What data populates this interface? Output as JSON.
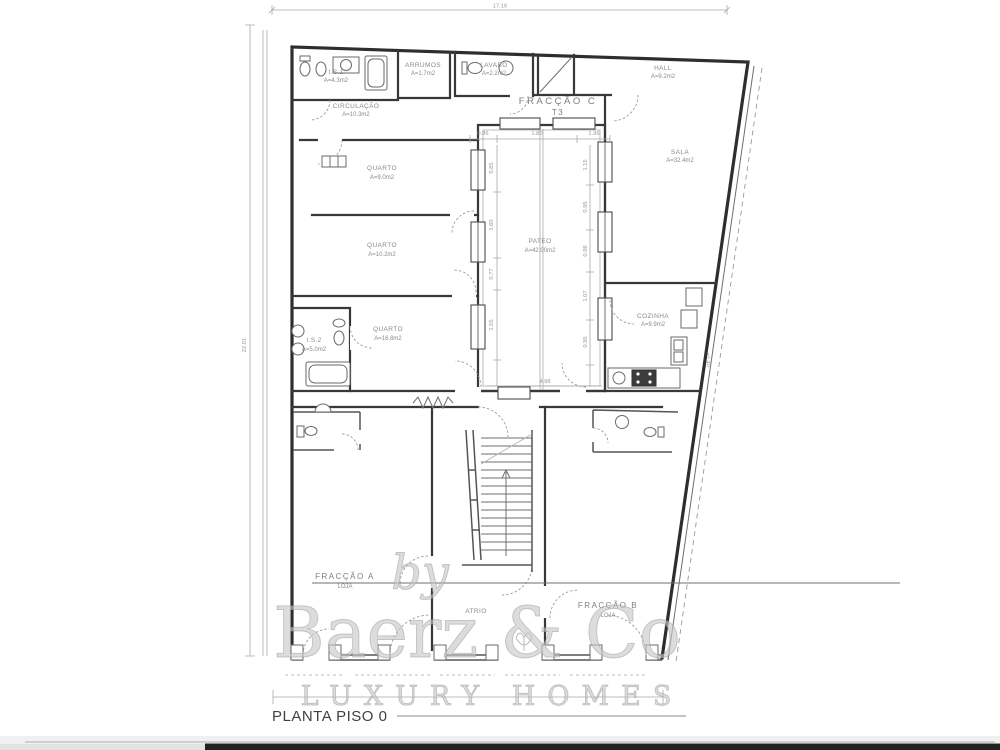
{
  "plan_title": "PLANTA PISO 0",
  "watermark": {
    "prefix": "by",
    "brand": "Baerz & Co",
    "tagline": "LUXURY HOMES"
  },
  "colors": {
    "wall": "#2e2e2e",
    "dimension": "#a8a8a8",
    "label": "#8a8a8a",
    "watermark": "#c6c6c6",
    "bottom_bar": "#212121"
  },
  "rooms": {
    "is1": {
      "name": "I.S.1",
      "area": "A=4.3m2"
    },
    "arrumos": {
      "name": "ARRUMOS",
      "area": "A=1.7m2"
    },
    "lavabo": {
      "name": "LAVABO",
      "area": "A=2.2m2"
    },
    "hall": {
      "name": "HALL",
      "area": "A=9.2m2"
    },
    "circulacao": {
      "name": "CIRCULAÇÃO",
      "area": "A=10.3m2"
    },
    "quarto1": {
      "name": "QUARTO",
      "area": "A=9.0m2"
    },
    "quarto2": {
      "name": "QUARTO",
      "area": "A=10.2m2"
    },
    "quarto3": {
      "name": "QUARTO",
      "area": "A=16.8m2"
    },
    "is2": {
      "name": "I.S.2",
      "area": "A=5.0m2"
    },
    "pateo": {
      "name": "PATEO",
      "area": "A=42.00m2"
    },
    "sala": {
      "name": "SALA",
      "area": "A=32.4m2"
    },
    "cozinha": {
      "name": "COZINHA",
      "area": "A=9.9m2"
    },
    "atrio": {
      "name": "ATRIO"
    },
    "fraccao_c": {
      "name": "FRACÇÃO C",
      "type": "T3"
    },
    "fraccao_a": {
      "name": "FRACÇÃO A",
      "type": "LOJA"
    },
    "fraccao_b": {
      "name": "FRACÇÃO B",
      "type": "LOJA"
    }
  },
  "dimensions": {
    "top_width": "17.16",
    "left_height": "22.01",
    "right_height": "22.40",
    "patio_top": [
      "0.86",
      "1.80",
      "1.96"
    ],
    "patio_bottom": "4.98",
    "patio_left": [
      "0.85",
      "1.60",
      "0.77",
      "1.55"
    ],
    "patio_right": [
      "1.15",
      "0.95",
      "0.98",
      "1.07",
      "0.95"
    ]
  }
}
